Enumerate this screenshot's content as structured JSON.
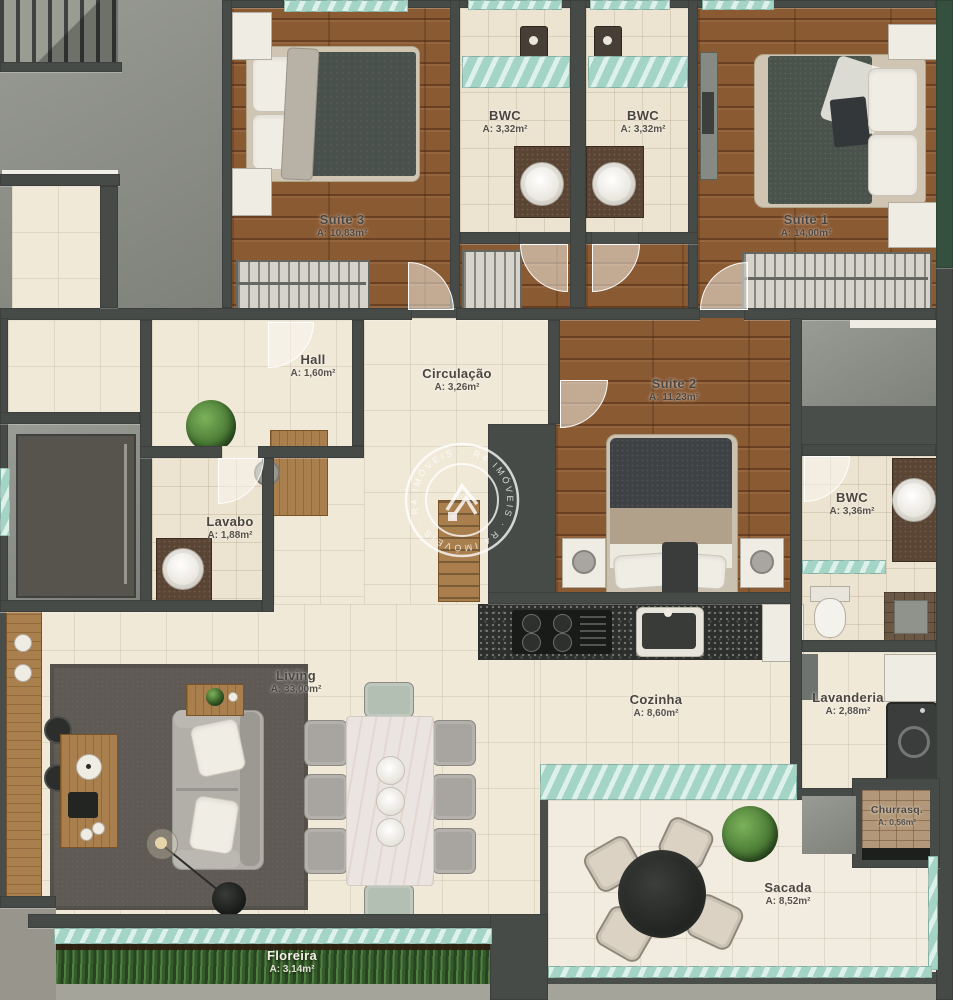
{
  "rooms": {
    "suite3": {
      "name": "Suite 3",
      "area": "A: 10,83m²"
    },
    "bwc_suite3": {
      "name": "BWC",
      "area": "A: 3,32m²"
    },
    "bwc_suite1": {
      "name": "BWC",
      "area": "A: 3,32m²"
    },
    "suite1": {
      "name": "Suite 1",
      "area": "A: 14,00m²"
    },
    "hall": {
      "name": "Hall",
      "area": "A: 1,60m²"
    },
    "circulacao": {
      "name": "Circulação",
      "area": "A: 3,26m²"
    },
    "suite2": {
      "name": "Suite 2",
      "area": "A: 11,23m²"
    },
    "lavabo": {
      "name": "Lavabo",
      "area": "A: 1,88m²"
    },
    "bwc_suite2": {
      "name": "BWC",
      "area": "A: 3,36m²"
    },
    "living": {
      "name": "Living",
      "area": "A: 33,00m²"
    },
    "cozinha": {
      "name": "Cozinha",
      "area": "A: 8,60m²"
    },
    "lavanderia": {
      "name": "Lavanderia",
      "area": "A: 2,88m²"
    },
    "churrasqueira": {
      "name": "Churrasq.",
      "area": "A: 0,56m²"
    },
    "sacada": {
      "name": "Sacada",
      "area": "A: 8,52m²"
    },
    "floreira": {
      "name": "Floreira",
      "area": "A: 3,14m²"
    }
  },
  "watermark": {
    "ring_text": "· R4 IMÓVEIS · R4 IMÓVEIS · R4 IMÓVEIS"
  },
  "colors": {
    "wall": "#474b48",
    "wood": "#8a5a33",
    "floor": "#f0e9d8",
    "concrete": "#90938b",
    "glass": "#abd9cb",
    "granite": "#2d2f2d",
    "plants": "#3a5a2e"
  }
}
